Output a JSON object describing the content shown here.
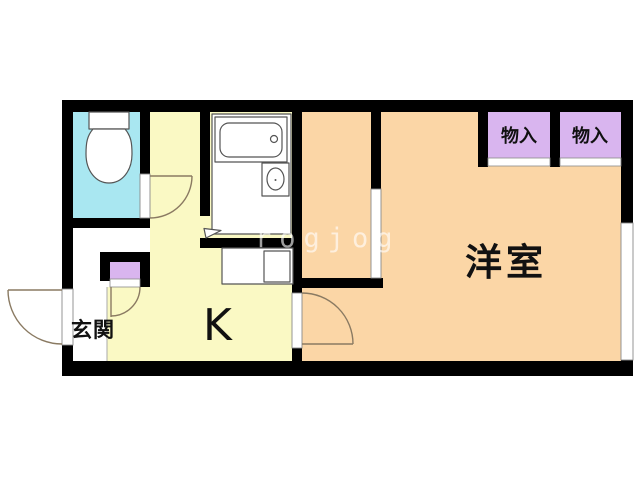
{
  "colors": {
    "wall": "#000000",
    "toilet_floor": "#A9E7F1",
    "kitchen_floor": "#FAF9C4",
    "room_floor": "#FBD6A6",
    "closet": "#D9B5EF",
    "door_line": "#8A7A62",
    "fixture_line": "#555555"
  },
  "rooms": {
    "entrance": {
      "label": "玄関"
    },
    "kitchen": {
      "label": "K"
    },
    "western_room": {
      "label": "洋室"
    },
    "closet_left": {
      "label": "物入"
    },
    "closet_right": {
      "label": "物入"
    }
  },
  "watermark": {
    "text": "rogjog"
  }
}
